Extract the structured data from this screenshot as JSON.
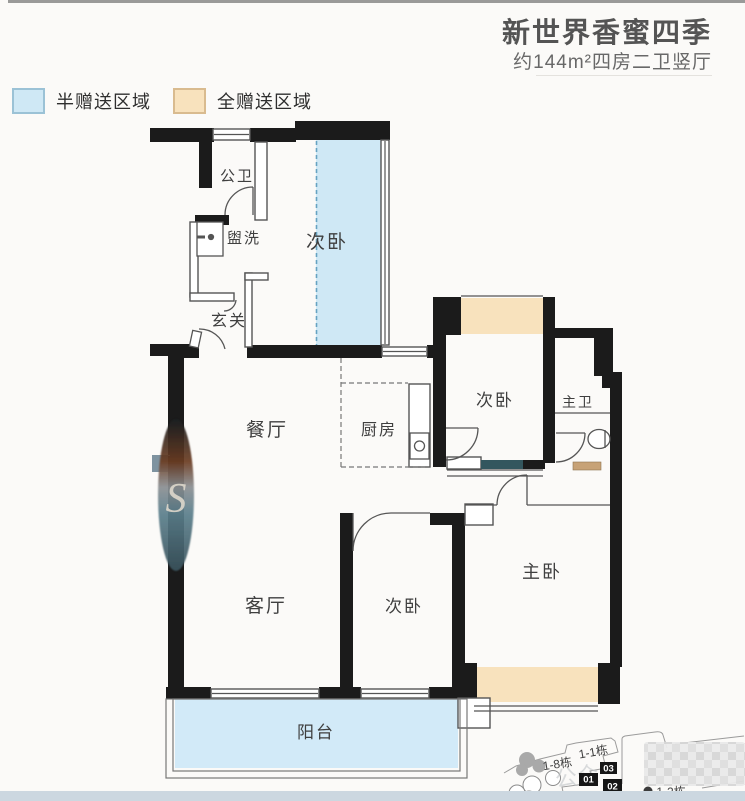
{
  "header": {
    "title": "新世界香蜜四季",
    "subtitle": "约144m²四房二卫竖厅"
  },
  "legend": {
    "half_gift": {
      "label": "半赠送区域",
      "fill": "#cfe8f5",
      "border": "#9bc2d6"
    },
    "full_gift": {
      "label": "全赠送区域",
      "fill": "#f8e2bd",
      "border": "#d9bb8f"
    }
  },
  "floorplan": {
    "rooms": [
      {
        "id": "public-bathroom",
        "label": "公卫"
      },
      {
        "id": "washroom",
        "label": "盥洗"
      },
      {
        "id": "bedroom-north",
        "label": "次卧"
      },
      {
        "id": "foyer",
        "label": "玄关"
      },
      {
        "id": "dining-room",
        "label": "餐厅"
      },
      {
        "id": "kitchen",
        "label": "厨房"
      },
      {
        "id": "bedroom-east",
        "label": "次卧"
      },
      {
        "id": "master-bathroom",
        "label": "主卫"
      },
      {
        "id": "living-room",
        "label": "客厅"
      },
      {
        "id": "bedroom-south",
        "label": "次卧"
      },
      {
        "id": "master-bedroom",
        "label": "主卧"
      },
      {
        "id": "balcony",
        "label": "阳台"
      }
    ],
    "colors": {
      "wall": "#1b1b1b",
      "half_gift_fill": "#cfe8f5",
      "full_gift_fill": "#f8e2bd",
      "outline": "#555555",
      "sliding_door": "#33565e",
      "door_sill": "#c7a276"
    }
  },
  "siteplan": {
    "building_labels": [
      "1-8栋",
      "1-1栋",
      "1-2栋"
    ],
    "unit_labels": [
      "01",
      "02",
      "03"
    ],
    "watermark_text": "公众"
  },
  "watermark": {
    "letter": "S"
  },
  "footer": {
    "strip_color": "#ccd7e0"
  }
}
